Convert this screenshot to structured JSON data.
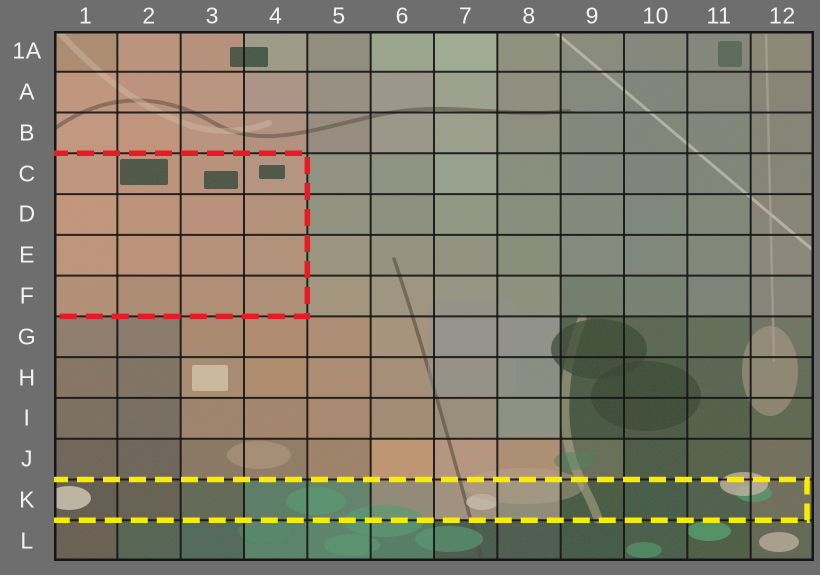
{
  "page": {
    "background_color": "#6e6e6e",
    "description": "Satellite image with alphanumeric grid reference overlay"
  },
  "map": {
    "x": 54,
    "y": 31,
    "width": 760,
    "height": 530
  },
  "grid": {
    "columns": [
      "1",
      "2",
      "3",
      "4",
      "5",
      "6",
      "7",
      "8",
      "9",
      "10",
      "11",
      "12"
    ],
    "rows": [
      "1A",
      "A",
      "B",
      "C",
      "D",
      "E",
      "F",
      "G",
      "H",
      "I",
      "J",
      "K",
      "L"
    ],
    "line_color": "#151515",
    "label_color": "#f2f2f2"
  },
  "highlights": [
    {
      "label": "red-dashed-region",
      "rows": "C-F",
      "columns": "1-4",
      "color": "#e81a23",
      "row_start": 3,
      "row_span": 4,
      "col_start": 0,
      "col_span": 4,
      "inset_right": 0,
      "dash": "17 9",
      "stroke_width": 5.5,
      "left_overhang": 3
    },
    {
      "label": "yellow-dashed-region",
      "rows": "K",
      "columns": "1-12",
      "color": "#f8ec00",
      "row_start": 11,
      "row_span": 1,
      "col_start": 0,
      "col_span": 12,
      "inset_right": 7,
      "dash": "17 9",
      "stroke_width": 5.5,
      "left_overhang": 3
    }
  ],
  "tiles": [
    [
      "#ab8a6d",
      "#bc9279",
      "#b69079",
      "#9c9a85",
      "#8f8c7c",
      "#9aa48c",
      "#9fac93",
      "#8d907d",
      "#86897a",
      "#838579",
      "#828478",
      "#8a8574"
    ],
    [
      "#c2947b",
      "#bf917a",
      "#bb937c",
      "#ac9384",
      "#968d80",
      "#9b9589",
      "#9aa18c",
      "#8c8d7c",
      "#82867a",
      "#7e8277",
      "#808377",
      "#868173"
    ],
    [
      "#c4967d",
      "#c29379",
      "#ba927b",
      "#b1907d",
      "#958a7d",
      "#9b9588",
      "#999e8a",
      "#8a8d7b",
      "#808578",
      "#7d8377",
      "#7e8376",
      "#828172"
    ],
    [
      "#c2947c",
      "#bd9178",
      "#b99079",
      "#b4937f",
      "#8f9180",
      "#8c917e",
      "#95a08c",
      "#878d7a",
      "#7e8579",
      "#7b8278",
      "#7d8377",
      "#808274"
    ],
    [
      "#c39579",
      "#bd9077",
      "#bb8f78",
      "#b49077",
      "#90917e",
      "#8b8f7c",
      "#909682",
      "#858b79",
      "#7f8779",
      "#7c8478",
      "#7e8476",
      "#848275"
    ],
    [
      "#c09377",
      "#bc9076",
      "#b78f76",
      "#b19076",
      "#9a947e",
      "#93927e",
      "#8f927e",
      "#868c78",
      "#80887a",
      "#7d8578",
      "#7f8476",
      "#888578"
    ],
    [
      "#b38d73",
      "#ac896f",
      "#b18c72",
      "#ad8d73",
      "#a3947c",
      "#9d947e",
      "#949380",
      "#8b8f7b",
      "#6f7b69",
      "#737e6e",
      "#7a8174",
      "#818275"
    ],
    [
      "#8d7a68",
      "#87766a",
      "#a8876c",
      "#b08a6c",
      "#ae8c70",
      "#a7917a",
      "#97938a",
      "#8e9088",
      "#4f5f49",
      "#55634e",
      "#5e6b55",
      "#6c7260"
    ],
    [
      "#83725f",
      "#7e6f60",
      "#a88a6e",
      "#ae8a6a",
      "#ab8b6f",
      "#a48c74",
      "#999082",
      "#868c80",
      "#465740",
      "#4a5a41",
      "#53614b",
      "#606953"
    ],
    [
      "#786c5c",
      "#746a5e",
      "#9c8168",
      "#a3836a",
      "#a8866c",
      "#a18a70",
      "#988d7a",
      "#8b9080",
      "#42533d",
      "#475640",
      "#4e5b44",
      "#5a654a"
    ],
    [
      "#6c6154",
      "#6a6156",
      "#87755f",
      "#8e7a62",
      "#9c8066",
      "#c0946f",
      "#b5947c",
      "#ac8d70",
      "#636b52",
      "#475741",
      "#505d46",
      "#6f6d58"
    ],
    [
      "#5f584c",
      "#625c4e",
      "#5e6552",
      "#577a63",
      "#5d8069",
      "#8f8876",
      "#a08f7d",
      "#8c8a74",
      "#43573f",
      "#405743",
      "#4a5c48",
      "#6c6a58"
    ],
    [
      "#655c4e",
      "#50604f",
      "#4b6655",
      "#538066",
      "#568267",
      "#507a61",
      "#445848",
      "#47584a",
      "#3e5542",
      "#435a45",
      "#49593f",
      "#5d6450"
    ]
  ],
  "map_features": [
    {
      "kind": "path",
      "d": "M 0,98 C 50,62 105,60 160,92 C 205,118 255,100 320,85 C 390,68 445,88 515,80",
      "stroke": "#55483a",
      "w": 4,
      "o": 0.55
    },
    {
      "kind": "path",
      "d": "M 4,0 C 40,38 75,72 135,94 C 165,104 195,100 215,92",
      "stroke": "#d9c6ab",
      "w": 6,
      "o": 0.4
    },
    {
      "kind": "path",
      "d": "M 500,0 L 760,220",
      "stroke": "#c9c5b5",
      "w": 3,
      "o": 0.7
    },
    {
      "kind": "path",
      "d": "M 712,0 L 720,330",
      "stroke": "#b5afa0",
      "w": 2.5,
      "o": 0.5
    },
    {
      "kind": "path",
      "d": "M 340,228 C 365,300 398,420 428,530",
      "stroke": "#4d4236",
      "w": 3.5,
      "o": 0.6
    },
    {
      "kind": "path",
      "d": "M 528,288 C 512,330 504,380 518,428 C 526,452 538,468 544,488",
      "stroke": "#cdbb98",
      "w": 9,
      "o": 0.45
    },
    {
      "kind": "rect",
      "x": 176,
      "y": 16,
      "w": 38,
      "h": 20,
      "fill": "#2c4233",
      "o": 0.8,
      "rx": 2
    },
    {
      "kind": "rect",
      "x": 66,
      "y": 128,
      "w": 48,
      "h": 26,
      "fill": "#2c4233",
      "o": 0.8,
      "rx": 2
    },
    {
      "kind": "rect",
      "x": 150,
      "y": 140,
      "w": 34,
      "h": 18,
      "fill": "#2c4233",
      "o": 0.8,
      "rx": 2
    },
    {
      "kind": "rect",
      "x": 205,
      "y": 134,
      "w": 26,
      "h": 14,
      "fill": "#2c4233",
      "o": 0.8,
      "rx": 2
    },
    {
      "kind": "rect",
      "x": 664,
      "y": 10,
      "w": 24,
      "h": 26,
      "fill": "#3a523f",
      "o": 0.6,
      "rx": 3
    },
    {
      "kind": "rect",
      "x": 374,
      "y": 268,
      "w": 88,
      "h": 96,
      "fill": "#90908a",
      "o": 0.5,
      "rx": 10
    },
    {
      "kind": "rect",
      "x": 138,
      "y": 334,
      "w": 36,
      "h": 26,
      "fill": "#d6c6a6",
      "o": 0.8,
      "rx": 2
    },
    {
      "kind": "ellipse",
      "cx": 545,
      "cy": 318,
      "rx": 48,
      "ry": 30,
      "fill": "#36452f",
      "o": 0.75
    },
    {
      "kind": "ellipse",
      "cx": 592,
      "cy": 365,
      "rx": 55,
      "ry": 35,
      "fill": "#31402c",
      "o": 0.6
    },
    {
      "kind": "ellipse",
      "cx": 262,
      "cy": 470,
      "rx": 30,
      "ry": 14,
      "fill": "#53996f",
      "o": 0.7
    },
    {
      "kind": "ellipse",
      "cx": 330,
      "cy": 490,
      "rx": 40,
      "ry": 16,
      "fill": "#53996f",
      "o": 0.7
    },
    {
      "kind": "ellipse",
      "cx": 395,
      "cy": 508,
      "rx": 34,
      "ry": 13,
      "fill": "#53996f",
      "o": 0.65
    },
    {
      "kind": "ellipse",
      "cx": 298,
      "cy": 514,
      "rx": 28,
      "ry": 11,
      "fill": "#53996f",
      "o": 0.6
    },
    {
      "kind": "ellipse",
      "cx": 210,
      "cy": 500,
      "rx": 26,
      "ry": 11,
      "fill": "#4d8a64",
      "o": 0.5
    },
    {
      "kind": "ellipse",
      "cx": 655,
      "cy": 500,
      "rx": 22,
      "ry": 10,
      "fill": "#4f9c6c",
      "o": 0.8
    },
    {
      "kind": "ellipse",
      "cx": 700,
      "cy": 462,
      "rx": 18,
      "ry": 9,
      "fill": "#4f9c6c",
      "o": 0.7
    },
    {
      "kind": "ellipse",
      "cx": 590,
      "cy": 519,
      "rx": 18,
      "ry": 8,
      "fill": "#4f9c6c",
      "o": 0.6
    },
    {
      "kind": "ellipse",
      "cx": 520,
      "cy": 430,
      "rx": 20,
      "ry": 9,
      "fill": "#467f58",
      "o": 0.5
    },
    {
      "kind": "ellipse",
      "cx": 15,
      "cy": 467,
      "rx": 22,
      "ry": 12,
      "fill": "#cfc5b4",
      "o": 0.85
    },
    {
      "kind": "ellipse",
      "cx": 428,
      "cy": 471,
      "rx": 16,
      "ry": 8,
      "fill": "#c9beae",
      "o": 0.8
    },
    {
      "kind": "ellipse",
      "cx": 690,
      "cy": 453,
      "rx": 24,
      "ry": 12,
      "fill": "#c9b7a4",
      "o": 0.75
    },
    {
      "kind": "ellipse",
      "cx": 725,
      "cy": 511,
      "rx": 20,
      "ry": 10,
      "fill": "#c4b2a2",
      "o": 0.75
    },
    {
      "kind": "ellipse",
      "cx": 716,
      "cy": 340,
      "rx": 28,
      "ry": 45,
      "fill": "#b09d86",
      "o": 0.55
    },
    {
      "kind": "ellipse",
      "cx": 205,
      "cy": 424,
      "rx": 32,
      "ry": 14,
      "fill": "#b99e84",
      "o": 0.5
    },
    {
      "kind": "ellipse",
      "cx": 470,
      "cy": 455,
      "rx": 60,
      "ry": 18,
      "fill": "#b7a48c",
      "o": 0.45
    }
  ]
}
